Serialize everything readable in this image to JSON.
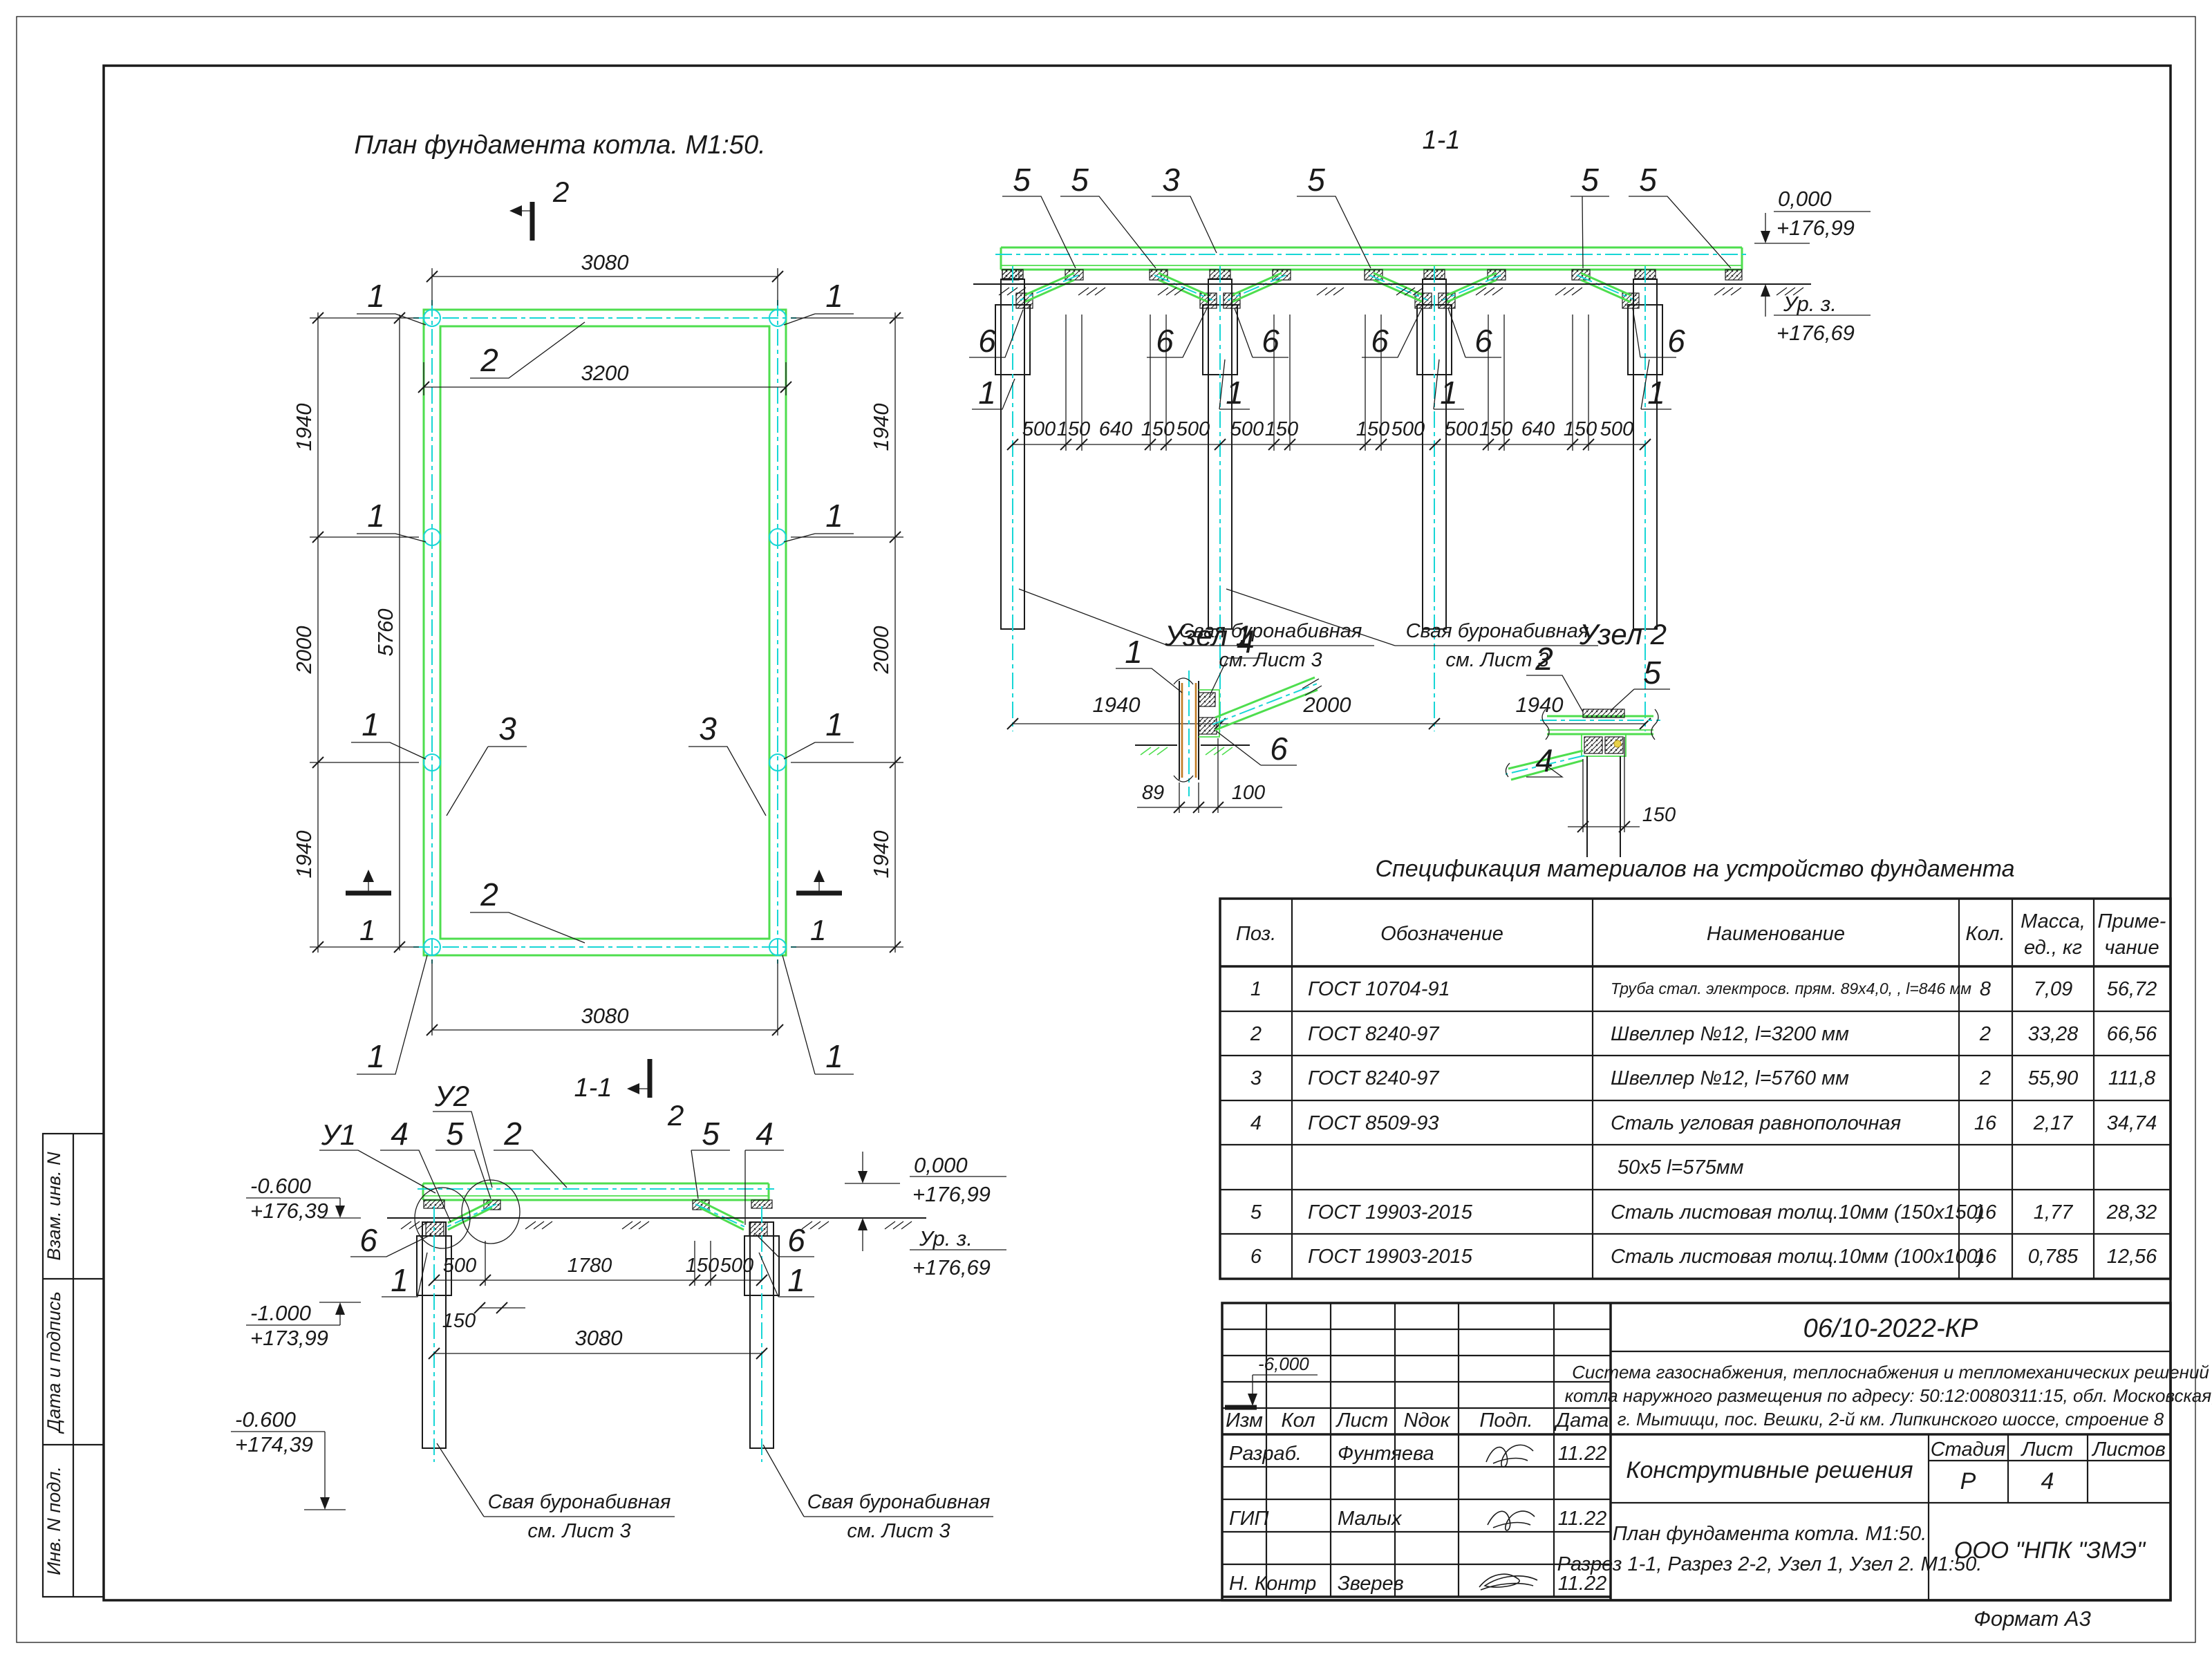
{
  "page": {
    "format_note": "Формат А3"
  },
  "colors": {
    "steel_green": "#4ede4e",
    "axis_cyan": "#17d6d6",
    "pipe_orange": "#c07a22"
  },
  "sidebar": {
    "items": [
      "Взам. инв. N",
      "Дата и подпись",
      "Инв. N подл."
    ]
  },
  "plan": {
    "title": "План фундамента котла. М1:50.",
    "dim_top": "3080",
    "dim_inner": "3200",
    "dim_bottom": "3080",
    "dim_total": "5760",
    "left_dims": [
      "1940",
      "2000",
      "1940"
    ],
    "right_dims": [
      "1940",
      "2000",
      "1940"
    ],
    "pile_callout": "1",
    "beam_short_callout": "2",
    "beam_long_callout": "3",
    "mark_vertical": "2",
    "mark_horizontal": "1"
  },
  "section1": {
    "title": "1-1",
    "callout_plate": "5",
    "callout_beam": "3",
    "callout_gusset": "6",
    "callout_pile": "1",
    "dim_chain": [
      "500",
      "150",
      "640",
      "150",
      "500",
      "500",
      "150",
      "150",
      "500",
      "500",
      "150",
      "640",
      "150",
      "500"
    ],
    "bottom_dims": [
      "1940",
      "2000",
      "1940"
    ],
    "elev_zero_label": "0,000",
    "elev_zero_value": "+176,99",
    "elev_ground_label": "Ур. з.",
    "elev_ground_value": "+176,69",
    "note_line1": "Свая буронабивная",
    "note_line2": "см. Лист 3"
  },
  "detail1": {
    "title": "Узел 1",
    "callout_pile": "1",
    "callout_angle": "4",
    "callout_plate": "6",
    "dim_pipe": "89",
    "dim_plate": "100"
  },
  "detail2": {
    "title": "Узел 2",
    "callout_beam": "2",
    "callout_plate": "5",
    "callout_angle": "4",
    "dim_plate": "150"
  },
  "section2": {
    "title": "1-1",
    "callout_u1": "У1",
    "callout_u2": "У2",
    "callout_angle": "4",
    "callout_plate": "5",
    "callout_beam": "2",
    "callout_gusset": "6",
    "callout_pile": "1",
    "dims": [
      "500",
      "1780",
      "150",
      "500"
    ],
    "dim_plate": "150",
    "dim_bottom": "3080",
    "elev1_label": "-0.600",
    "elev1_value": "+176,39",
    "elev2_label": "-1.000",
    "elev2_value": "+173,99",
    "elev3_label": "-0.600",
    "elev3_value": "+174,39",
    "elev_zero_label": "0,000",
    "elev_zero_value": "+176,99",
    "elev_ground_label": "Ур. з.",
    "elev_ground_value": "+176,69",
    "note_line1": "Свая буронабивная",
    "note_line2": "см. Лист 3"
  },
  "spec": {
    "title": "Спецификация материалов на устройство фундамента",
    "h_pos": "Поз.",
    "h_design": "Обозначение",
    "h_name": "Наименование",
    "h_qty": "Кол.",
    "h_mass1": "Масса,",
    "h_mass2": "ед., кг",
    "h_note1": "Приме-",
    "h_note2": "чание",
    "rows": [
      [
        "1",
        "ГОСТ 10704-91",
        "Труба стал. электросв. прям. 89х4,0, , l=846 мм",
        "8",
        "7,09",
        "56,72"
      ],
      [
        "2",
        "ГОСТ 8240-97",
        "Швеллер №12, l=3200 мм",
        "2",
        "33,28",
        "66,56"
      ],
      [
        "3",
        "ГОСТ 8240-97",
        "Швеллер №12, l=5760 мм",
        "2",
        "55,90",
        "111,8"
      ],
      [
        "4",
        "ГОСТ 8509-93",
        "Сталь угловая равнополочная",
        "16",
        "2,17",
        "34,74"
      ],
      [
        "",
        "",
        "50х5 l=575мм",
        "",
        "",
        ""
      ],
      [
        "5",
        "ГОСТ 19903-2015",
        "Сталь листовая толщ.10мм (150х150)",
        "16",
        "1,77",
        "28,32"
      ],
      [
        "6",
        "ГОСТ 19903-2015",
        "Сталь листовая толщ.10мм (100х100)",
        "16",
        "0,785",
        "12,56"
      ]
    ]
  },
  "title_block": {
    "doc_number": "06/10-2022-КР",
    "description_lines": [
      "Система газоснабжения, теплоснабжения и тепломеханических решений",
      "котла наружного размещения по адресу: 50:12:0080311:15, обл. Московская,",
      "г. Мытищи, пос. Вешки, 2-й км. Липкинского шоссе, строение 8"
    ],
    "columns": [
      "Изм",
      "Кол",
      "Лист",
      "Nдок",
      "Подп.",
      "Дата"
    ],
    "rows": [
      {
        "role": "Разраб.",
        "name": "Фунтяева",
        "date": "11.22"
      },
      {
        "role": "ГИП",
        "name": "Малых",
        "date": "11.22"
      },
      {
        "role": "Н. Контр",
        "name": "Зверев",
        "date": "11.22"
      }
    ],
    "section_title": "Конструтивные решения",
    "stage_headers": [
      "Стадия",
      "Лист",
      "Листов"
    ],
    "stage": "Р",
    "sheet": "4",
    "sheets": "",
    "drawing_title_line1": "План фундамента котла. М1:50.",
    "drawing_title_line2": "Разрез 1-1, Разрез 2-2, Узел 1, Узел 2. М1:50.",
    "company": "ООО \"НПК \"ЗМЭ\"",
    "elevation_mark": "-6,000"
  }
}
